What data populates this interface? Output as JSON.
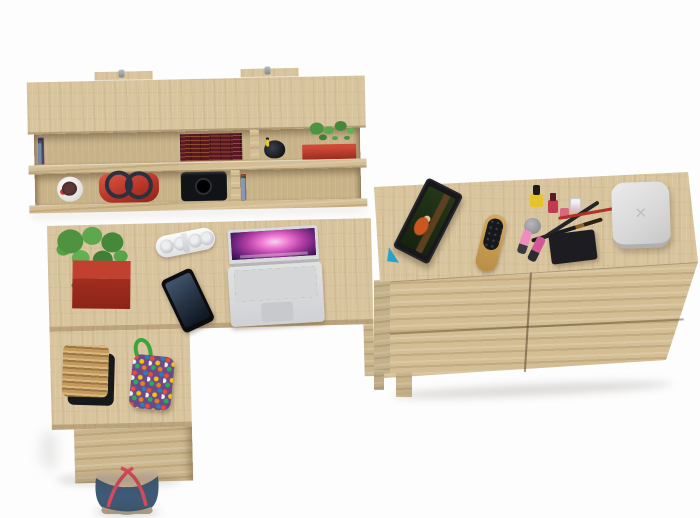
{
  "scene": {
    "title": "Top view of a home office furniture set in light oak: wall shelf, L-shaped desk and sideboard on a white background",
    "colors": {
      "bg": "#fdfdfd",
      "wood-top": "#d8c49d",
      "wood-front": "#d3bd93",
      "wood-inner": "#c8b389",
      "accent-red": "#c0392b",
      "planter-red": "#a12d20",
      "laptop-silver": "#d7d9db",
      "foliage-green": "#4e9440",
      "denim-blue": "#3e5a76",
      "strap-red": "#d84a5a",
      "bookset-maroon": "#5c1624",
      "bookset-gold": "#cea442"
    }
  },
  "wall_shelf": {
    "label": "wall-mounted shelf with two rows",
    "mount_tabs": 2,
    "top_row_books": [
      {
        "c": "#ece7db",
        "h": 24,
        "w": 5
      },
      {
        "c": "#8fa3b8",
        "h": 22,
        "w": 4
      },
      {
        "c": "#f2eee2",
        "h": 26,
        "w": 6
      },
      {
        "c": "#d9d1c0",
        "h": 21,
        "w": 4
      },
      {
        "c": "#25355c",
        "h": 25,
        "w": 5
      },
      {
        "c": "#efe9dc",
        "h": 23,
        "w": 4
      },
      {
        "c": "#7a1d2e",
        "h": 26,
        "w": 5
      },
      {
        "c": "#2b2b33",
        "h": 22,
        "w": 4
      },
      {
        "c": "#e7c9d6",
        "h": 25,
        "w": 5
      },
      {
        "c": "#d23b8e",
        "h": 27,
        "w": 6
      },
      {
        "c": "#a02c78",
        "h": 24,
        "w": 5
      },
      {
        "c": "#5b2f7e",
        "h": 26,
        "w": 4
      },
      {
        "c": "#1f6b74",
        "h": 22,
        "w": 5
      },
      {
        "c": "#eee8da",
        "h": 24,
        "w": 4
      },
      {
        "c": "#27456e",
        "h": 26,
        "w": 5
      },
      {
        "c": "#17181d",
        "h": 23,
        "w": 4
      },
      {
        "c": "#e3dccb",
        "h": 21,
        "w": 5
      },
      {
        "c": "#9fc0d8",
        "h": 25,
        "w": 4
      },
      {
        "c": "#33343c",
        "h": 24,
        "w": 5
      },
      {
        "c": "#c3a368",
        "h": 20,
        "w": 4
      },
      {
        "c": "#1d3a66",
        "h": 26,
        "w": 5
      },
      {
        "c": "#e8e2d2",
        "h": 22,
        "w": 4
      },
      {
        "c": "#4a4e58",
        "h": 24,
        "w": 5
      },
      {
        "c": "#7289a8",
        "h": 21,
        "w": 4
      }
    ],
    "bottom_row_books": [
      {
        "c": "#3f6650",
        "h": 24,
        "w": 5
      },
      {
        "c": "#e4ded0",
        "h": 22,
        "w": 4
      },
      {
        "c": "#2e7f86",
        "h": 26,
        "w": 5
      },
      {
        "c": "#16233f",
        "h": 24,
        "w": 4
      },
      {
        "c": "#6e4a2a",
        "h": 22,
        "w": 5
      },
      {
        "c": "#8a8478",
        "h": 20,
        "w": 4
      },
      {
        "c": "#23262e",
        "h": 25,
        "w": 5
      },
      {
        "c": "#7a1f2a",
        "h": 26,
        "w": 5
      },
      {
        "c": "#d8d2c2",
        "h": 21,
        "w": 4
      },
      {
        "c": "#2d5f8a",
        "h": 24,
        "w": 5
      },
      {
        "c": "#0f2547",
        "h": 26,
        "w": 4
      },
      {
        "c": "#cfc7b4",
        "h": 22,
        "w": 5
      },
      {
        "c": "#463a63",
        "h": 25,
        "w": 4
      },
      {
        "c": "#8a6a3a",
        "h": 21,
        "w": 5
      },
      {
        "c": "#174f5e",
        "h": 24,
        "w": 4
      },
      {
        "c": "#b5402f",
        "h": 26,
        "w": 5
      },
      {
        "c": "#22303e",
        "h": 23,
        "w": 4
      },
      {
        "c": "#ded6c4",
        "h": 20,
        "w": 5
      },
      {
        "c": "#2b6b45",
        "h": 24,
        "w": 4
      },
      {
        "c": "#8699b4",
        "h": 22,
        "w": 5
      }
    ],
    "pens": [
      {
        "c": "#c0392b",
        "h": 8
      },
      {
        "c": "#2b6cb0",
        "h": 6
      },
      {
        "c": "#16181d",
        "h": 9
      },
      {
        "c": "#e8c83a",
        "h": 7
      }
    ],
    "items": [
      "colorful books",
      "maroon leather book set with gilding",
      "pen cup",
      "green plant in red planter",
      "white flower pot",
      "red handbag",
      "black camera",
      "more books"
    ]
  },
  "desk": {
    "label": "L-shaped desk with under-desk drawer pedestal",
    "items": [
      "green plant in red box planter",
      "white power strip",
      "black smartphone",
      "silver laptop with pink nebula wallpaper",
      "wicker basket on black tray",
      "multicolor beaded pouch with green cord"
    ]
  },
  "sideboard": {
    "label": "wide sideboard with two columns of drawers",
    "items": [
      "tablet propped on blue stand showing red-haired girl",
      "wooden hairbrush",
      "yellow nail polish",
      "grey cosmetic jar",
      "red nail polishes",
      "perfume bottle",
      "two makeup brushes",
      "red pencil",
      "two pink lipsticks",
      "eyeshadow palette",
      "white rounded box"
    ],
    "palette_pans": [
      {
        "c": "#e9c2d4"
      },
      {
        "c": "#d8a4bc"
      },
      {
        "c": "#c393ae"
      },
      {
        "c": "#b5809e"
      },
      {
        "c": "#e2cdd9"
      },
      {
        "c": "#caa6ba"
      }
    ],
    "white_box_glyph": "✕"
  },
  "floor_bag": {
    "label": "denim tote bag with red straps on floor"
  }
}
